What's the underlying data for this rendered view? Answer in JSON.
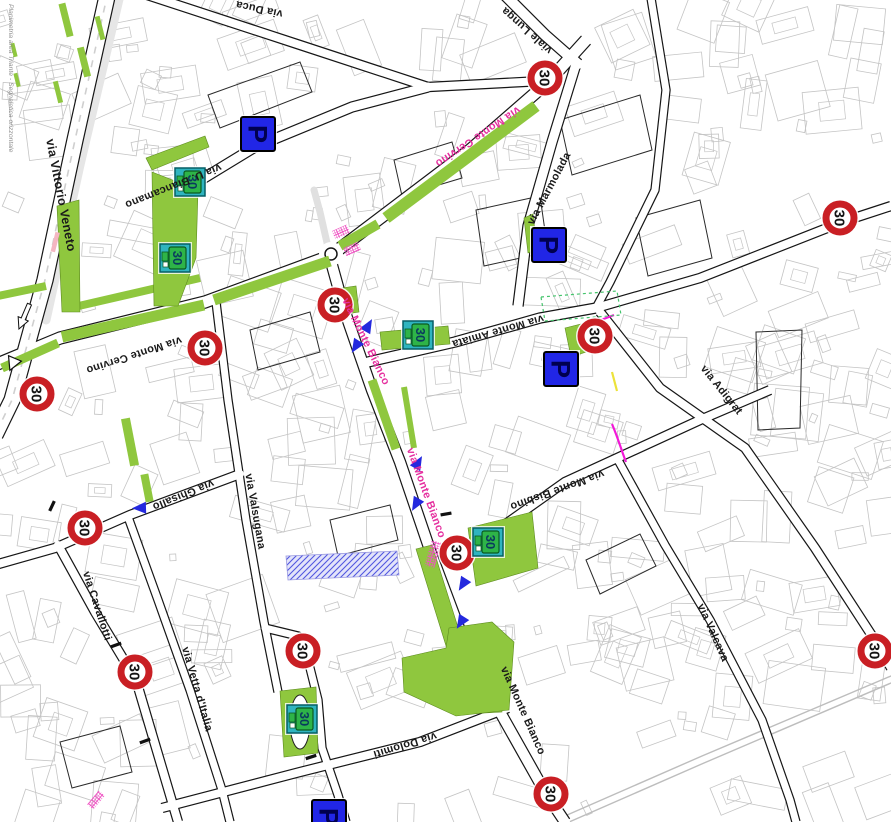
{
  "map": {
    "caption_left": "Planimetria area Triante - Segnaletica orizzontale",
    "colors": {
      "green_area": "#8fc73e",
      "speed_sign_red": "#c91f24",
      "sign_text_black": "#141414",
      "parking_blue": "#2126e6",
      "parking_glyph": "#000050",
      "zone_sign_teal": "#2fb4bf",
      "zone_sign_green": "#2eb448",
      "zone_sign_glyph": "#0a3a5e",
      "crossing_magenta": "#ef53c3",
      "magenta_line": "#f318d8",
      "street_label_black": "#1a1a1a",
      "street_label_magenta": "#e5309f",
      "arrow_blue": "#2429de",
      "building_outline": "#c4c4c4",
      "block_outline": "#2a2a2a",
      "road_black": "#161616",
      "caption_gray": "#8d8d8d",
      "blue_hatch": "#5157e0",
      "green_dashed": "#44c46c",
      "yellow_mark": "#ece23a",
      "pink_dash": "#f4b6c2"
    },
    "speed_limit_signs": {
      "value": "30",
      "positions": [
        [
          545,
          78
        ],
        [
          840,
          218
        ],
        [
          205,
          348
        ],
        [
          37,
          394
        ],
        [
          335,
          305
        ],
        [
          595,
          336
        ],
        [
          85,
          528
        ],
        [
          135,
          672
        ],
        [
          303,
          651
        ],
        [
          457,
          553
        ],
        [
          875,
          651
        ],
        [
          551,
          794
        ]
      ]
    },
    "parking_signs": {
      "label": "P",
      "positions": [
        [
          258,
          134
        ],
        [
          549,
          245
        ],
        [
          561,
          369
        ],
        [
          329,
          817
        ]
      ]
    },
    "zone30_signs": {
      "label": "30",
      "positions": [
        [
          190,
          182
        ],
        [
          175,
          258
        ],
        [
          418,
          335
        ],
        [
          488,
          542
        ],
        [
          302,
          719
        ]
      ]
    },
    "street_labels": [
      {
        "text": "via Vittorio Veneto",
        "x": 57,
        "y": 196,
        "r": 79,
        "c": "black",
        "fs": 12.5
      },
      {
        "text": "via U. Biancamano",
        "x": 172,
        "y": 183,
        "r": 158,
        "c": "black",
        "fs": 11
      },
      {
        "text": "via Duca",
        "x": 260,
        "y": 6,
        "r": 192,
        "c": "black",
        "fs": 11
      },
      {
        "text": "viale Lunga",
        "x": 529,
        "y": 28,
        "r": 222,
        "c": "black",
        "fs": 11
      },
      {
        "text": "via Monte Cervino",
        "x": 476,
        "y": 134,
        "r": 146,
        "c": "magenta",
        "fs": 11
      },
      {
        "text": "via Monte Cervino",
        "x": 133,
        "y": 352,
        "r": 162,
        "c": "black",
        "fs": 11
      },
      {
        "text": "via Marmolada",
        "x": 552,
        "y": 190,
        "r": -62,
        "c": "black",
        "fs": 11
      },
      {
        "text": "via Monte Amiata",
        "x": 497,
        "y": 328,
        "r": 164,
        "c": "black",
        "fs": 11
      },
      {
        "text": "via Adigrat",
        "x": 719,
        "y": 392,
        "r": 51,
        "c": "black",
        "fs": 11
      },
      {
        "text": "via Ghisallo",
        "x": 182,
        "y": 492,
        "r": 158,
        "c": "black",
        "fs": 11
      },
      {
        "text": "via Valsugana",
        "x": 252,
        "y": 512,
        "r": 80,
        "c": "black",
        "fs": 11
      },
      {
        "text": "via Cavallotti",
        "x": 94,
        "y": 607,
        "r": 72,
        "c": "black",
        "fs": 11
      },
      {
        "text": "via Vetta d'Italia",
        "x": 194,
        "y": 690,
        "r": 74,
        "c": "black",
        "fs": 11
      },
      {
        "text": "via Monte Bisbino",
        "x": 556,
        "y": 487,
        "r": 160,
        "c": "black",
        "fs": 11
      },
      {
        "text": "via Monte Bianco",
        "x": 363,
        "y": 343,
        "r": 64,
        "c": "magenta",
        "fs": 11
      },
      {
        "text": "via Monte Bianco",
        "x": 423,
        "y": 494,
        "r": 70,
        "c": "magenta",
        "fs": 11
      },
      {
        "text": "via Monte Bianco",
        "x": 520,
        "y": 712,
        "r": 66,
        "c": "black",
        "fs": 11
      },
      {
        "text": "via Valcava",
        "x": 710,
        "y": 634,
        "r": 66,
        "c": "black",
        "fs": 11
      },
      {
        "text": "via Dolomiti",
        "x": 404,
        "y": 742,
        "r": 163,
        "c": "black",
        "fs": 11
      }
    ]
  }
}
